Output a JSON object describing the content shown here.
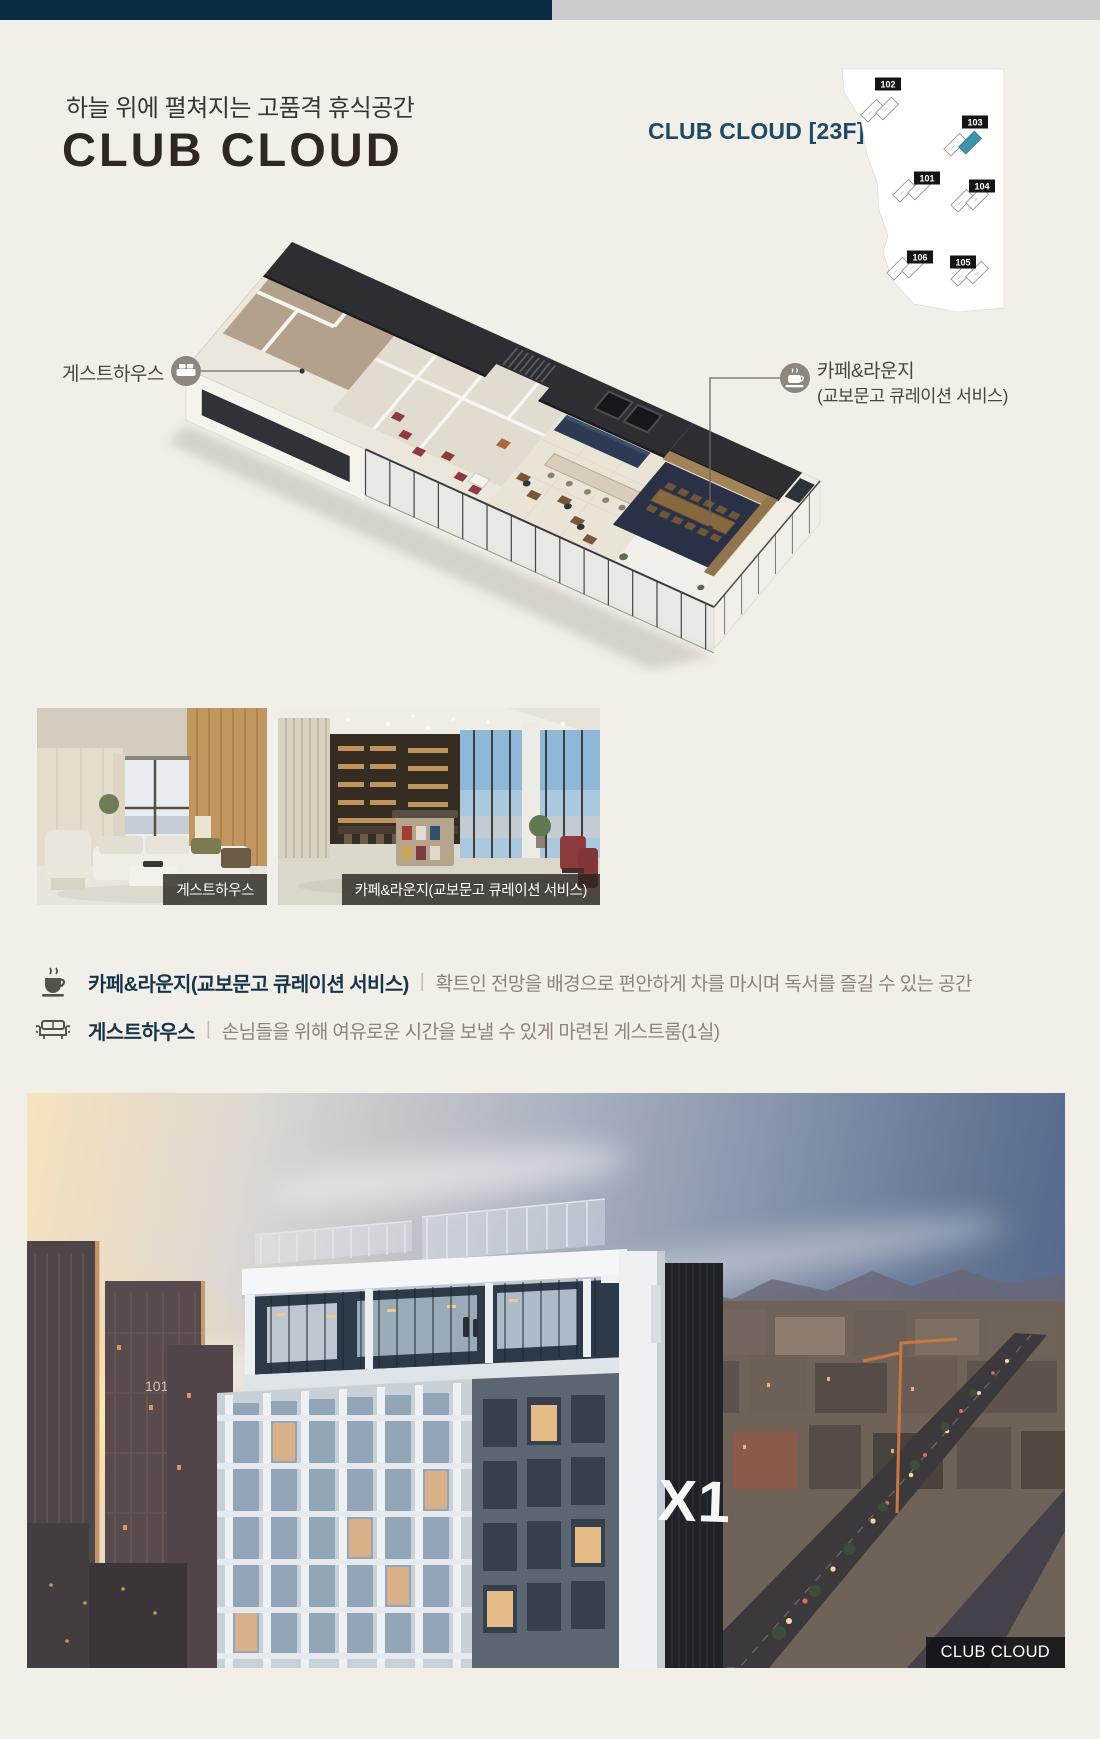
{
  "header": {
    "subtitle": "하늘 위에 펼쳐지는 고품격 휴식공간",
    "title": "CLUB CLOUD",
    "floor_tag": "CLUB CLOUD [23F]",
    "accent_color": "#1d4b66"
  },
  "site_plan": {
    "highlight_color": "#3f93ac",
    "buildings": [
      "102",
      "103",
      "101",
      "104",
      "106",
      "105"
    ]
  },
  "floor_plan": {
    "left_label": "게스트하우스",
    "right_label_line1": "카페&라운지",
    "right_label_line2": "(교보문고 큐레이션 서비스)"
  },
  "photos": {
    "left_caption": "게스트하우스",
    "right_caption": "카페&라운지(교보문고 큐레이션 서비스)"
  },
  "features": [
    {
      "name": "카페&라운지(교보문고 큐레이션 서비스)",
      "divider": "|",
      "desc": "확트인 전망을 배경으로 편안하게 차를 마시며 독서를 즐길 수 있는 공간"
    },
    {
      "name": "게스트하우스",
      "divider": "|",
      "desc": "손님들을 위해 여유로운 시간을 보낼 수 있게 마련된 게스트룸(1실)"
    }
  ],
  "hero": {
    "caption": "CLUB CLOUD",
    "logo": "X1",
    "tower_label": "101"
  }
}
